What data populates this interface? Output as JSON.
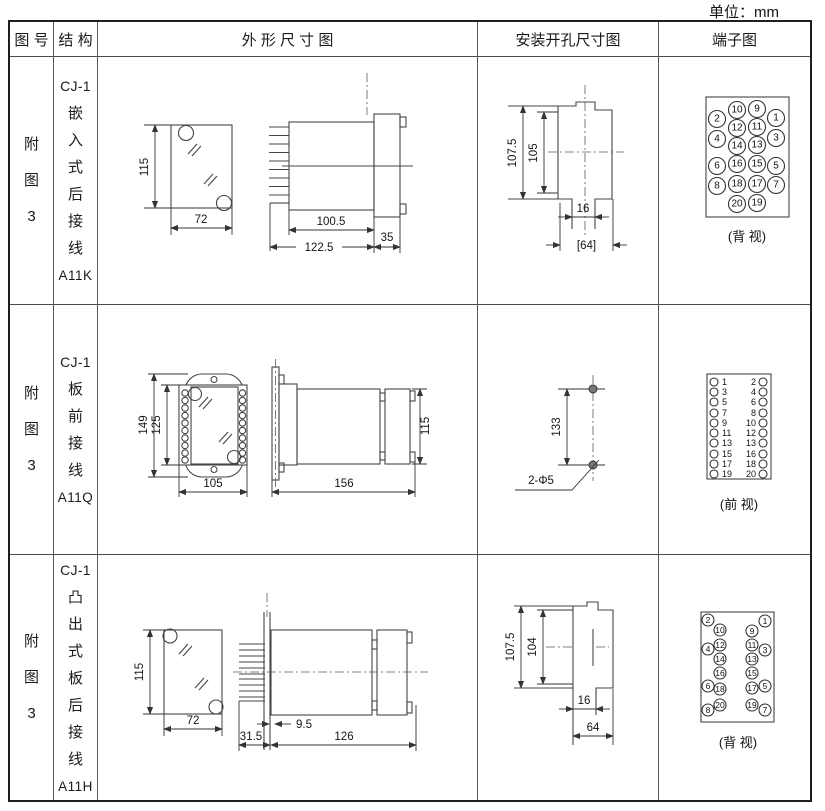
{
  "unit_label": "单位：mm",
  "header": {
    "figure": "图 号",
    "structure": "结 构",
    "outline": "外 形 尺 寸 图",
    "install": "安装开孔尺寸图",
    "terminal": "端子图"
  },
  "rows": [
    {
      "figure": "附图3",
      "structure": {
        "prefix": "CJ-1",
        "name": "嵌入式后接线",
        "code": "A11K"
      },
      "outline": {
        "front_h": "115",
        "front_w": "72",
        "side_d1": "100.5",
        "side_d2": "122.5",
        "side_d3": "35"
      },
      "install": {
        "v1": "107.5",
        "v2": "105",
        "h1": "16",
        "h2": "[64]"
      },
      "terminal": {
        "view": "(背 视)",
        "pins": [
          {
            "n": "10",
            "x": 78,
            "y": 53
          },
          {
            "n": "9",
            "x": 98,
            "y": 52
          },
          {
            "n": "2",
            "x": 58,
            "y": 62
          },
          {
            "n": "1",
            "x": 117,
            "y": 61
          },
          {
            "n": "12",
            "x": 78,
            "y": 71
          },
          {
            "n": "11",
            "x": 98,
            "y": 70
          },
          {
            "n": "4",
            "x": 58,
            "y": 82
          },
          {
            "n": "3",
            "x": 117,
            "y": 81
          },
          {
            "n": "14",
            "x": 78,
            "y": 89
          },
          {
            "n": "13",
            "x": 98,
            "y": 88
          },
          {
            "n": "16",
            "x": 78,
            "y": 107
          },
          {
            "n": "15",
            "x": 98,
            "y": 107
          },
          {
            "n": "6",
            "x": 58,
            "y": 109
          },
          {
            "n": "5",
            "x": 117,
            "y": 109
          },
          {
            "n": "18",
            "x": 78,
            "y": 127
          },
          {
            "n": "17",
            "x": 98,
            "y": 127
          },
          {
            "n": "8",
            "x": 58,
            "y": 129
          },
          {
            "n": "7",
            "x": 117,
            "y": 128
          },
          {
            "n": "20",
            "x": 78,
            "y": 147
          },
          {
            "n": "19",
            "x": 98,
            "y": 146
          }
        ]
      }
    },
    {
      "figure": "附图3",
      "structure": {
        "prefix": "CJ-1",
        "name": "板前接线",
        "code": "A11Q"
      },
      "outline": {
        "front_d1": "149",
        "front_d2": "125",
        "front_w": "105",
        "side_w": "156",
        "side_h": "115"
      },
      "install": {
        "v1": "133",
        "hole": "2-Φ5"
      },
      "terminal": {
        "view": "(前 视)",
        "pins": [
          {
            "n": "1",
            "x": 55,
            "y": 77,
            "tx": 63,
            "ty": 77,
            "anchor": "start"
          },
          {
            "n": "2",
            "x": 104,
            "y": 77,
            "tx": 97,
            "ty": 77,
            "anchor": "end"
          },
          {
            "n": "3",
            "x": 55,
            "y": 87,
            "tx": 63,
            "ty": 87,
            "anchor": "start"
          },
          {
            "n": "4",
            "x": 104,
            "y": 87,
            "tx": 97,
            "ty": 87,
            "anchor": "end"
          },
          {
            "n": "5",
            "x": 55,
            "y": 97,
            "tx": 63,
            "ty": 97,
            "anchor": "start"
          },
          {
            "n": "6",
            "x": 104,
            "y": 97,
            "tx": 97,
            "ty": 97,
            "anchor": "end"
          },
          {
            "n": "7",
            "x": 55,
            "y": 108,
            "tx": 63,
            "ty": 108,
            "anchor": "start"
          },
          {
            "n": "8",
            "x": 104,
            "y": 108,
            "tx": 97,
            "ty": 108,
            "anchor": "end"
          },
          {
            "n": "9",
            "x": 55,
            "y": 118,
            "tx": 63,
            "ty": 118,
            "anchor": "start"
          },
          {
            "n": "10",
            "x": 104,
            "y": 118,
            "tx": 97,
            "ty": 118,
            "anchor": "end"
          },
          {
            "n": "11",
            "x": 55,
            "y": 128,
            "tx": 63,
            "ty": 128,
            "anchor": "start"
          },
          {
            "n": "12",
            "x": 104,
            "y": 128,
            "tx": 97,
            "ty": 128,
            "anchor": "end"
          },
          {
            "n": "13",
            "x": 55,
            "y": 138,
            "tx": 63,
            "ty": 138,
            "anchor": "start"
          },
          {
            "n": "13",
            "x": 104,
            "y": 138,
            "tx": 97,
            "ty": 138,
            "anchor": "end"
          },
          {
            "n": "15",
            "x": 55,
            "y": 149,
            "tx": 63,
            "ty": 149,
            "anchor": "start"
          },
          {
            "n": "16",
            "x": 104,
            "y": 149,
            "tx": 97,
            "ty": 149,
            "anchor": "end"
          },
          {
            "n": "17",
            "x": 55,
            "y": 159,
            "tx": 63,
            "ty": 159,
            "anchor": "start"
          },
          {
            "n": "18",
            "x": 104,
            "y": 159,
            "tx": 97,
            "ty": 159,
            "anchor": "end"
          },
          {
            "n": "19",
            "x": 55,
            "y": 169,
            "tx": 63,
            "ty": 169,
            "anchor": "start"
          },
          {
            "n": "20",
            "x": 104,
            "y": 169,
            "tx": 97,
            "ty": 169,
            "anchor": "end"
          }
        ]
      }
    },
    {
      "figure": "附图3",
      "structure": {
        "prefix": "CJ-1",
        "name": "凸出式板后接线",
        "code": "A11H"
      },
      "outline": {
        "front_h": "115",
        "front_w": "72",
        "side_d1": "31.5",
        "side_d2": "9.5",
        "side_d3": "126"
      },
      "install": {
        "v1": "107.5",
        "v2": "104",
        "h1": "16",
        "h2": "64"
      },
      "terminal": {
        "view": "(背 视)",
        "pins": [
          {
            "n": "2",
            "x": 49,
            "y": 65
          },
          {
            "n": "1",
            "x": 106,
            "y": 66
          },
          {
            "n": "10",
            "x": 61,
            "y": 75
          },
          {
            "n": "9",
            "x": 93,
            "y": 76
          },
          {
            "n": "12",
            "x": 61,
            "y": 90
          },
          {
            "n": "11",
            "x": 93,
            "y": 90
          },
          {
            "n": "4",
            "x": 49,
            "y": 94
          },
          {
            "n": "3",
            "x": 106,
            "y": 95
          },
          {
            "n": "14",
            "x": 61,
            "y": 104
          },
          {
            "n": "13",
            "x": 93,
            "y": 104
          },
          {
            "n": "16",
            "x": 61,
            "y": 118
          },
          {
            "n": "15",
            "x": 93,
            "y": 118
          },
          {
            "n": "6",
            "x": 49,
            "y": 131
          },
          {
            "n": "5",
            "x": 106,
            "y": 131
          },
          {
            "n": "18",
            "x": 61,
            "y": 134
          },
          {
            "n": "17",
            "x": 93,
            "y": 133
          },
          {
            "n": "20",
            "x": 61,
            "y": 150
          },
          {
            "n": "19",
            "x": 93,
            "y": 150
          },
          {
            "n": "8",
            "x": 49,
            "y": 155
          },
          {
            "n": "7",
            "x": 106,
            "y": 155
          }
        ]
      }
    }
  ]
}
